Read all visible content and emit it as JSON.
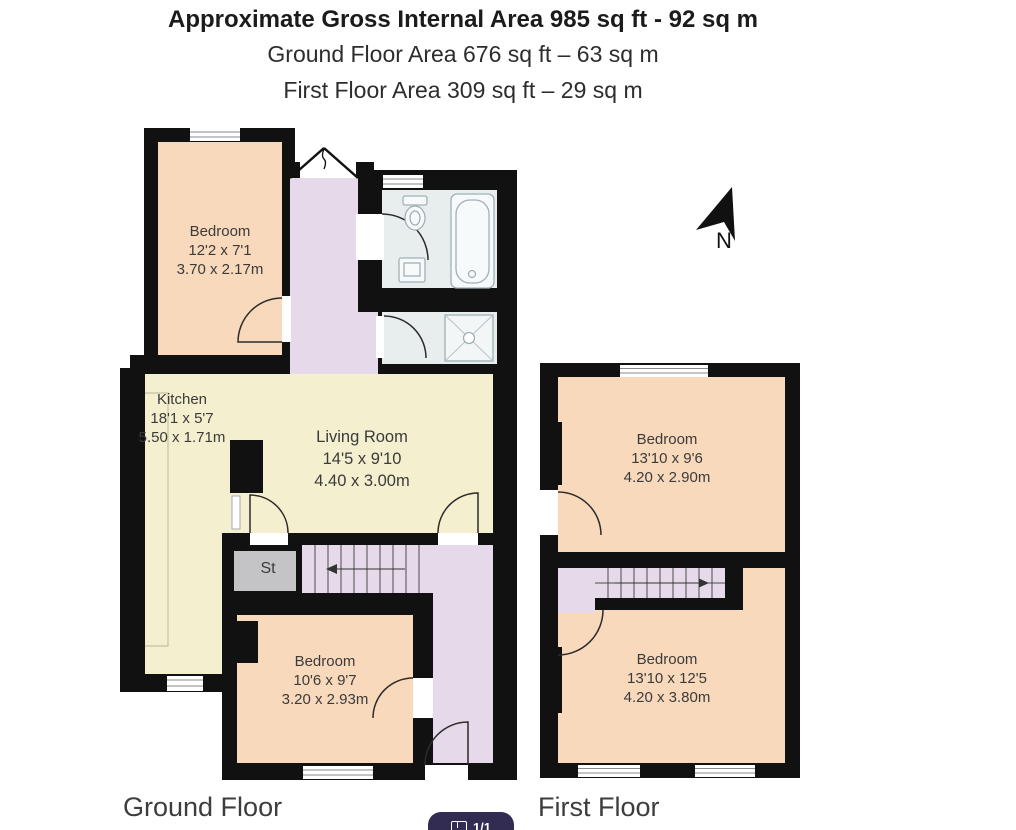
{
  "header": {
    "line1": "Approximate Gross Internal Area 985 sq ft - 92 sq m",
    "line2": "Ground Floor Area 676 sq ft – 63 sq m",
    "line3": "First Floor Area 309 sq ft – 29 sq m"
  },
  "compass": {
    "label": "N"
  },
  "floors": [
    {
      "label": "Ground Floor",
      "rooms": [
        {
          "name": "Bedroom",
          "imperial": "12'2 x 7'1",
          "metric": "3.70 x 2.17m"
        },
        {
          "name": "Kitchen",
          "imperial": "18'1 x 5'7",
          "metric": "5.50 x 1.71m"
        },
        {
          "name": "Living Room",
          "imperial": "14'5 x 9'10",
          "metric": "4.40 x 3.00m"
        },
        {
          "name": "St"
        },
        {
          "name": "Bedroom",
          "imperial": "10'6 x 9'7",
          "metric": "3.20 x 2.93m"
        }
      ]
    },
    {
      "label": "First Floor",
      "rooms": [
        {
          "name": "Bedroom",
          "imperial": "13'10 x 9'6",
          "metric": "4.20 x 2.90m"
        },
        {
          "name": "Bedroom",
          "imperial": "13'10 x 12'5",
          "metric": "4.20 x 3.80m"
        }
      ]
    }
  ],
  "badge": {
    "label": "1/1"
  },
  "colors": {
    "wall": "#111111",
    "bedroom_floor": "#f8d9bb",
    "living_floor": "#f4efce",
    "hall_floor": "#e6d9e9",
    "bath_floor": "#e8eeee",
    "storage": "#c4c3c6",
    "badge_bg": "#332c52"
  }
}
